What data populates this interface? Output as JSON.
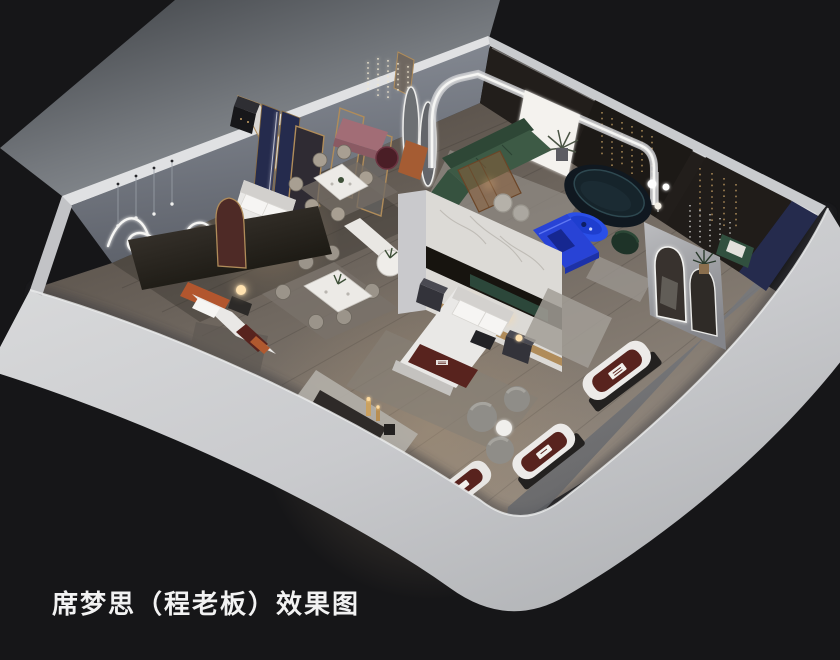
{
  "caption": {
    "text": "席梦思（程老板）效果图"
  },
  "palette": {
    "background": "#161618",
    "caption_text": "#f2f2f2",
    "outside_ground_light": "#9ba0a5",
    "outside_ground_dark": "#3d4044",
    "wall_band_light": "#dcddde",
    "wall_band_mid": "#aeb0b3",
    "wall_top_face": "#e0e1e3",
    "wall_inner_bluegray": "#7c818a",
    "wall_inner_dark": "#221e1b",
    "floor_dark": "#4c443d",
    "floor_mid": "#6f675f",
    "floor_light": "#978d82",
    "marble": "#dcdad6",
    "gold": "#b08c5a",
    "navy_panel": "#252b4d",
    "accent_blue": "#2a4fe8",
    "accent_blue_dark": "#2843d6",
    "teal_sofa": "#101820",
    "green_sofa": "#3d5a45",
    "green_dark": "#2e4736",
    "maroon_runner": "#58231e",
    "pink_bench": "#a26d76",
    "wine_table": "#4a1e26",
    "bedding_white": "#e9e8e6",
    "rug_gray": "#a29d96",
    "orange_leather": "#a55c33",
    "wood_amber": "#8a5f3a",
    "led_white": "#f6f6f4",
    "lamp_warm": "#ffe2b0"
  }
}
